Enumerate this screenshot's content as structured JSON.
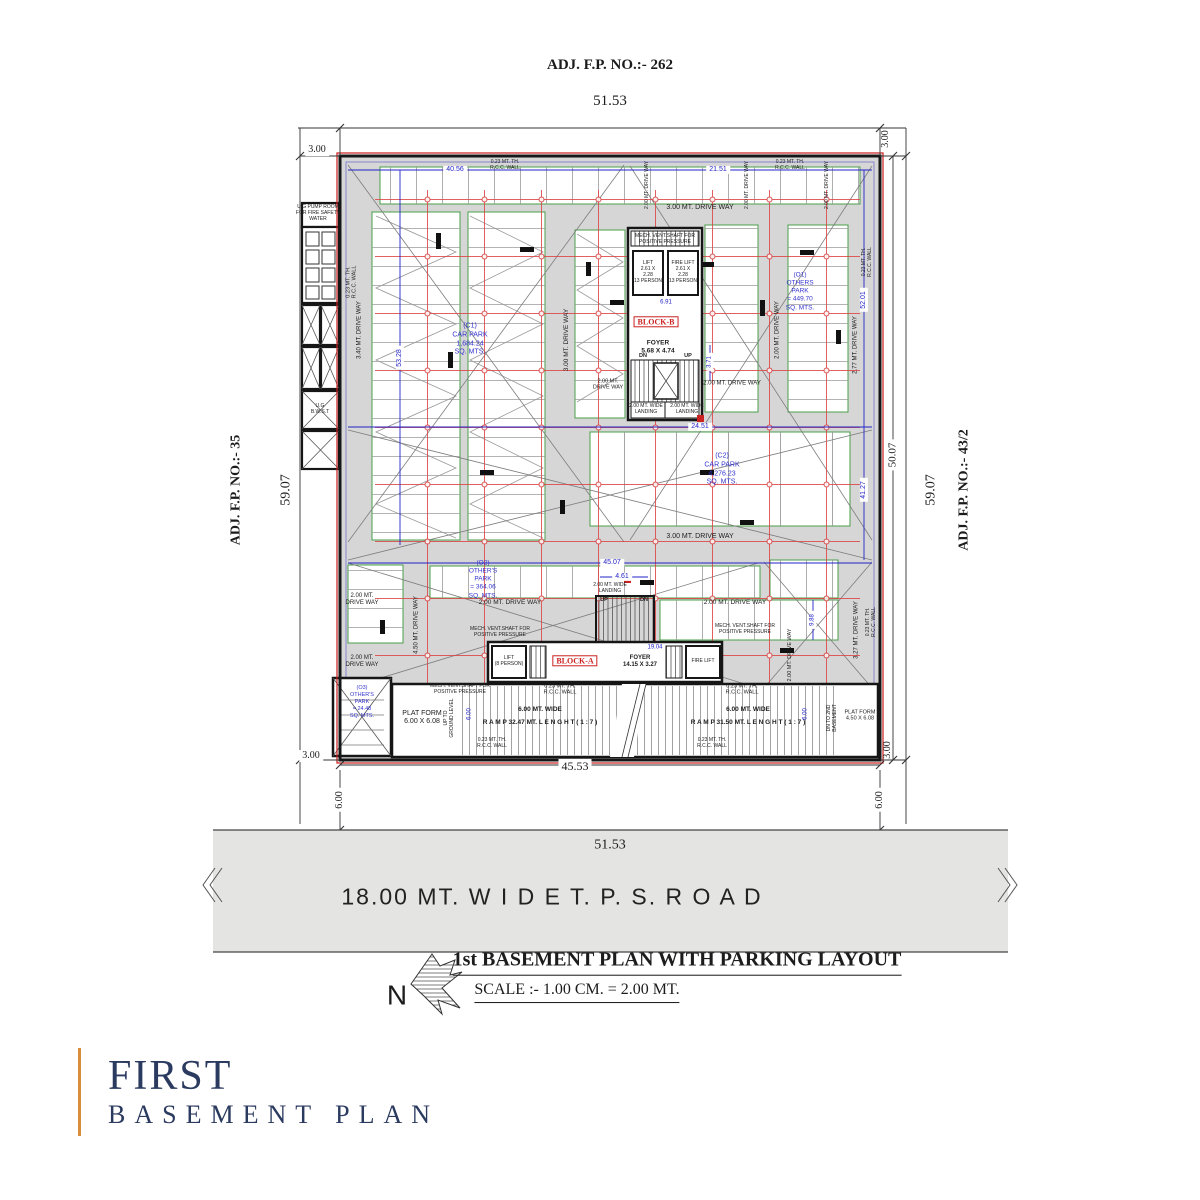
{
  "header": {
    "adj_fp_top": "ADJ. F.P. NO.:- 262"
  },
  "adjacent": {
    "left": "ADJ. F.P. NO.:- 35",
    "right": "ADJ. F.P. NO.:- 43/2"
  },
  "dims": {
    "w_top": "51.53",
    "w_road": "51.53",
    "h_left": "59.07",
    "h_right": "59.07",
    "h_inner": "50.07",
    "w_bottom": "45.53",
    "setback": "3.00",
    "road_offset": "6.00",
    "d4056": "40.56",
    "d5328": "53.28",
    "d2151": "21.51",
    "d2451": "24.51",
    "d4507": "45.07",
    "d461": "4.61",
    "d5201": "52.01",
    "d4127": "41.27",
    "d1904": "19.04",
    "d691": "6.91",
    "d371": "3.71",
    "d988": "9.88",
    "ramp_w": "6.00"
  },
  "plan": {
    "driveways": {
      "d340": "3.40 MT. DRIVE WAY",
      "d300": "3.00 MT. DRIVE WAY",
      "d200": "2.00 MT. DRIVE WAY",
      "d200_2l": "2.00 MT.\nDRIVE WAY",
      "d277": "2.77 MT. DRIVE WAY",
      "d450": "4.50 MT. DRIVE WAY",
      "d327": "3.27 MT. DRIVE WAY"
    },
    "walls": {
      "rcc": "0.23 MT. TH.\nR.C.C. WALL",
      "rcc_only": "R.C.C. WALL"
    },
    "parks": {
      "c1": "(C1)\nCAR PARK\n1,684.24\nSQ. MTS.",
      "c2": "(C2)\nCAR PARK\n4,276.23\nSQ. MTS.",
      "o1": "(O1)\nOTHERS\nPARK\n= 449.70\nSQ. MTS.",
      "o2": "(O2)\nOTHER'S\nPARK\n= 364.06\nSQ. MTS.",
      "o3": "(O3)\nOTHER'S\nPARK\n= 24.48\nSQ. MTS."
    },
    "block_b": {
      "name": "BLOCK-B",
      "foyer": "FOYER\n5.68 X 4.74",
      "lift": "LIFT\n2.61 X\n2.28\n(13 PERSON)",
      "fire_lift": "FIRE LIFT\n2.61 X\n2.28\n(13 PERSON)",
      "up": "UP",
      "dn": "DN",
      "landing": "2.00 MT. WIDE\nLANDING"
    },
    "block_a": {
      "name": "BLOCK-A",
      "foyer": "FOYER\n14.15 X 3.27",
      "lift": "LIFT\n(8 PERSON)",
      "fire_lift": "FIRE LIFT",
      "up": "UP",
      "dn": "DN",
      "landing": "2.00 MT. WIDE\nLANDING"
    },
    "vent": "MECH. VENT.SHAFT FOR\nPOSITIVE PRESSURE",
    "ramp": {
      "left": "R A M P  32.47 MT.  L E N G H T  ( 1 : 7 )",
      "right": "R A M P  31.50 MT.  L E N G H T  ( 1 : 7 )",
      "wide": "6.00 MT. WIDE",
      "up_note": "UP TO\nGROUND LEVEL",
      "dn_note": "DN TO 2ND\nBASEMENT",
      "platform_left": "PLAT FORM\n6.00 X 6.08",
      "platform_right": "PLAT FORM\n4.50 X 6.08"
    },
    "pump_room": "U.G PUMP ROOM\nFOR FIRE SAFETY\nWATER",
    "bwst": "U.G\nB.W.S.T"
  },
  "road": {
    "label": "18.00 MT.  W I D E    T. P. S.    R O A D"
  },
  "caption": {
    "north": "N",
    "title": "1st  BASEMENT  PLAN WITH PARKING LAYOUT",
    "scale": "SCALE :- 1.00 CM. = 2.00 MT."
  },
  "title_block": {
    "line1": "FIRST",
    "line2": "BASEMENT PLAN"
  },
  "colors": {
    "accent_orange": "#d98e3c",
    "navy": "#2b3a5f",
    "grid_red": "#dd4444",
    "dim_blue": "#2323c8",
    "stall_green": "#4a9e4a",
    "boundary_red": "#cc1a1a"
  }
}
